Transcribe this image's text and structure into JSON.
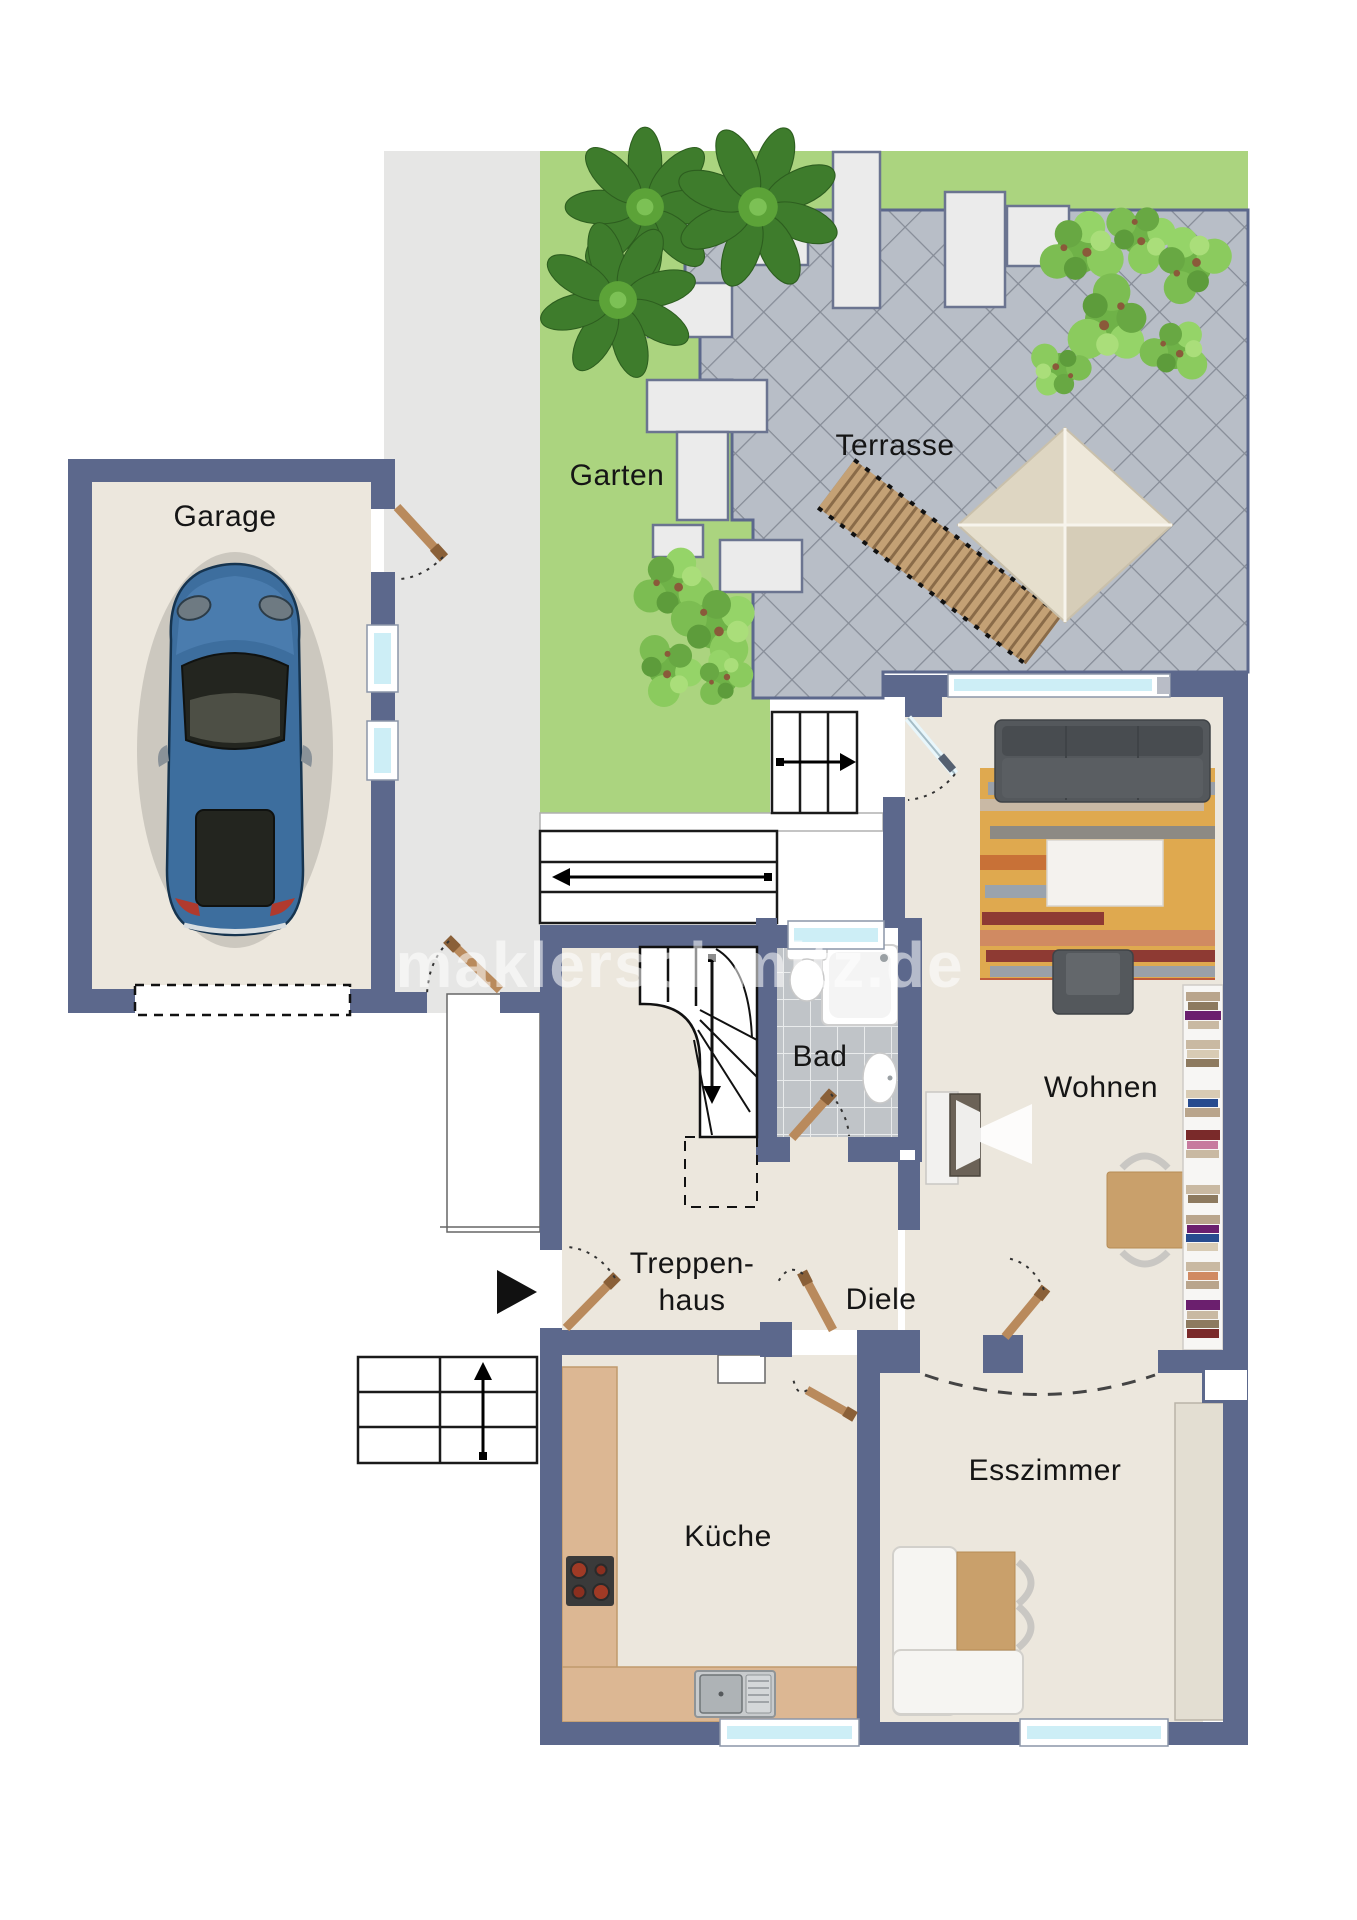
{
  "plan": {
    "type": "floorplan",
    "labels": {
      "garage": "Garage",
      "garten": "Garten",
      "terrasse": "Terrasse",
      "wohnen": "Wohnen",
      "bad": "Bad",
      "treppenhaus_line1": "Treppen-",
      "treppenhaus_line2": "haus",
      "diele": "Diele",
      "kueche": "Küche",
      "esszimmer": "Esszimmer"
    },
    "watermark": "maklerschmitz.de",
    "colors": {
      "wall": "#5c688c",
      "floor": "#ece7dd",
      "garden": "#abd47f",
      "path_gray": "#e6e6e5",
      "terrace_tile": "#b8bec7",
      "terrace_grout": "#868c97",
      "bath_tile": "#c0c4c8",
      "glass": "#cdeef6",
      "wood_door": "#b98a5c",
      "kitchen_counter": "#dcb793",
      "rug_base": "#dfa94f",
      "sofa": "#54585c",
      "car_body": "#3d6e9e"
    }
  }
}
